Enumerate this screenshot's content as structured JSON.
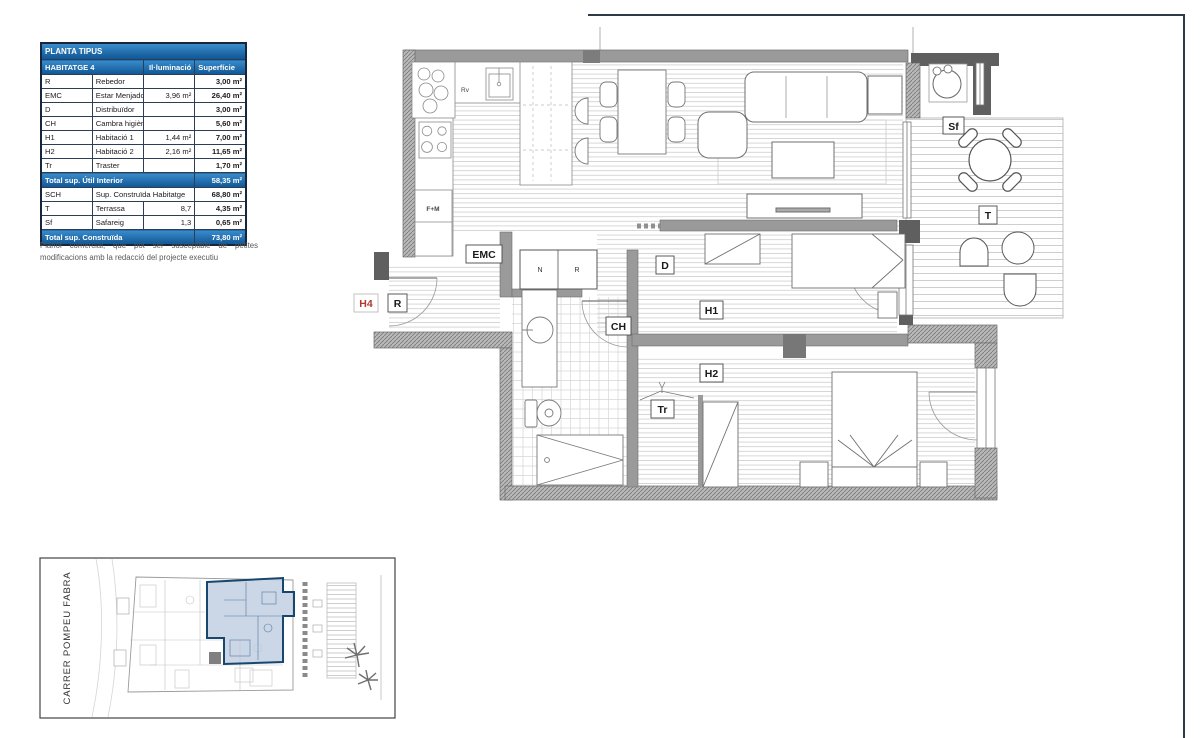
{
  "table": {
    "title": "PLANTA TIPUS",
    "columns": {
      "name": "HABITATGE 4",
      "illumination": "Il·luminació",
      "surface": "Superfície"
    },
    "rows": [
      {
        "code": "R",
        "label": "Rebedor",
        "illum": "",
        "area": "3,00 m²"
      },
      {
        "code": "EMC",
        "label": "Estar Menjador Cuina",
        "illum": "3,96 m²",
        "area": "26,40 m²"
      },
      {
        "code": "D",
        "label": "Distribuïdor",
        "illum": "",
        "area": "3,00 m²"
      },
      {
        "code": "CH",
        "label": "Cambra higiènica",
        "illum": "",
        "area": "5,60 m²"
      },
      {
        "code": "H1",
        "label": "Habitació 1",
        "illum": "1,44 m²",
        "area": "7,00 m²"
      },
      {
        "code": "H2",
        "label": "Habitació 2",
        "illum": "2,16 m²",
        "area": "11,65 m²"
      },
      {
        "code": "Tr",
        "label": "Traster",
        "illum": "",
        "area": "1,70 m²"
      }
    ],
    "total_util": {
      "label": "Total sup. Útil Interior",
      "area": "58,35 m²"
    },
    "built_row": {
      "code": "SCH",
      "label": "Sup. Construïda Habitatge",
      "area": "68,80 m²"
    },
    "annex_rows": [
      {
        "code": "T",
        "label": "Terrassa",
        "illum": "8,7",
        "area": "4,35 m²"
      },
      {
        "code": "Sf",
        "label": "Safareig",
        "illum": "1,3",
        "area": "0,65 m²"
      }
    ],
    "total_built": {
      "label": "Total sup. Construïda",
      "area": "73,80 m²"
    }
  },
  "note": "Plànol comercial, que pot ser susceptible de petites modificacions amb la redacció del projecte executiu",
  "plan": {
    "unit_tag": "H4",
    "labels": {
      "emc": "EMC",
      "rebedor": "R",
      "distribuidor": "D",
      "cambra_higienica": "CH",
      "habitacio1": "H1",
      "habitacio2": "H2",
      "traster": "Tr",
      "safareig": "Sf",
      "terrassa": "T",
      "closet_n": "N",
      "closet_r": "R",
      "sink_rv": "Rv",
      "fridge_unit": "F+M"
    }
  },
  "site_plan": {
    "street_label": "CARRER POMPEU FABRA"
  },
  "colors": {
    "table_blue": "#3b8ccb",
    "table_blue_deep": "#0f5695",
    "border_navy": "#2e3a45",
    "unit_red": "#b03a2e",
    "wall_gray": "#9a9a9a",
    "wall_dark": "#5f5f5f",
    "site_blue": "#17466e",
    "site_blue_fill": "#b9c9dd"
  }
}
